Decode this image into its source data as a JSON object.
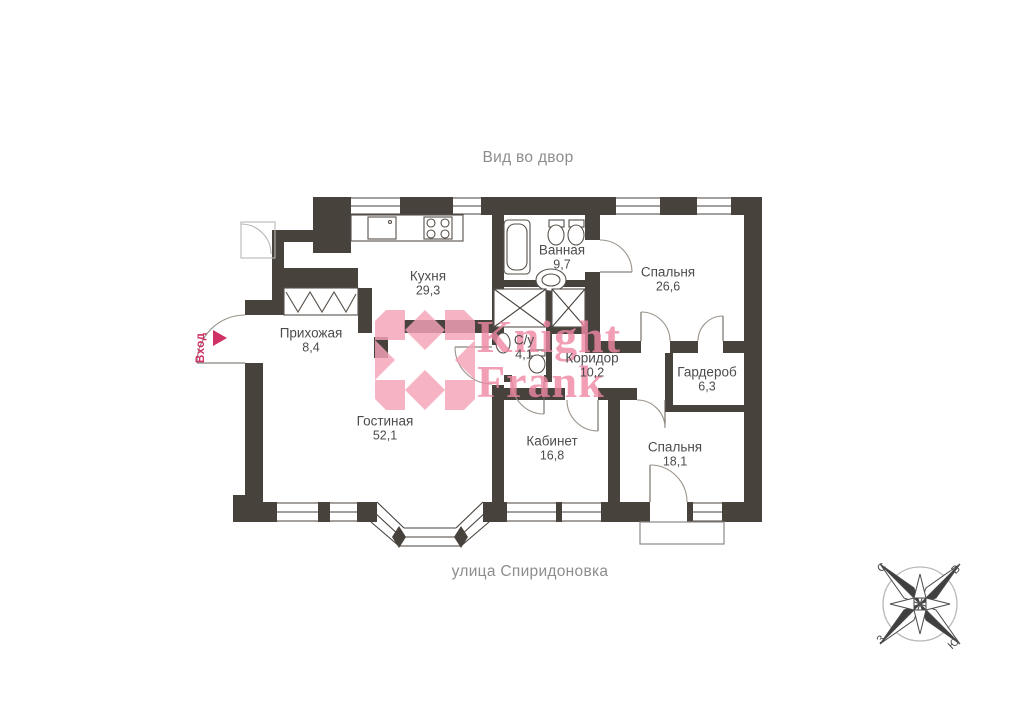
{
  "plan": {
    "top_label": "Вид во двор",
    "street_label": "улица Спиридоновка"
  },
  "entrance": {
    "label": "Вход"
  },
  "watermark": {
    "line1": "Knight",
    "line2": "Frank"
  },
  "colors": {
    "wall": "#48423D",
    "watermark_pink": "#F5A3B8",
    "watermark_text_pink": "#EF87A3",
    "entrance_red": "#CF3164",
    "room_label_text": "#4C4C4C",
    "muted_text": "#8D8D8D"
  },
  "rooms": [
    {
      "name": "Кухня",
      "area": "29,3"
    },
    {
      "name": "Ванная",
      "area": "9,7"
    },
    {
      "name": "Спальня",
      "area": "26,6"
    },
    {
      "name": "Прихожая",
      "area": "8,4"
    },
    {
      "name": "С/у",
      "area": "4,1"
    },
    {
      "name": "Коридор",
      "area": "10,2"
    },
    {
      "name": "Гардероб",
      "area": "6,3"
    },
    {
      "name": "Гостиная",
      "area": "52,1"
    },
    {
      "name": "Кабинет",
      "area": "16,8"
    },
    {
      "name": "Спальня",
      "area": "18,1"
    }
  ],
  "compass": {
    "north": "С",
    "east": "В",
    "west": "З",
    "south": "Ю"
  }
}
